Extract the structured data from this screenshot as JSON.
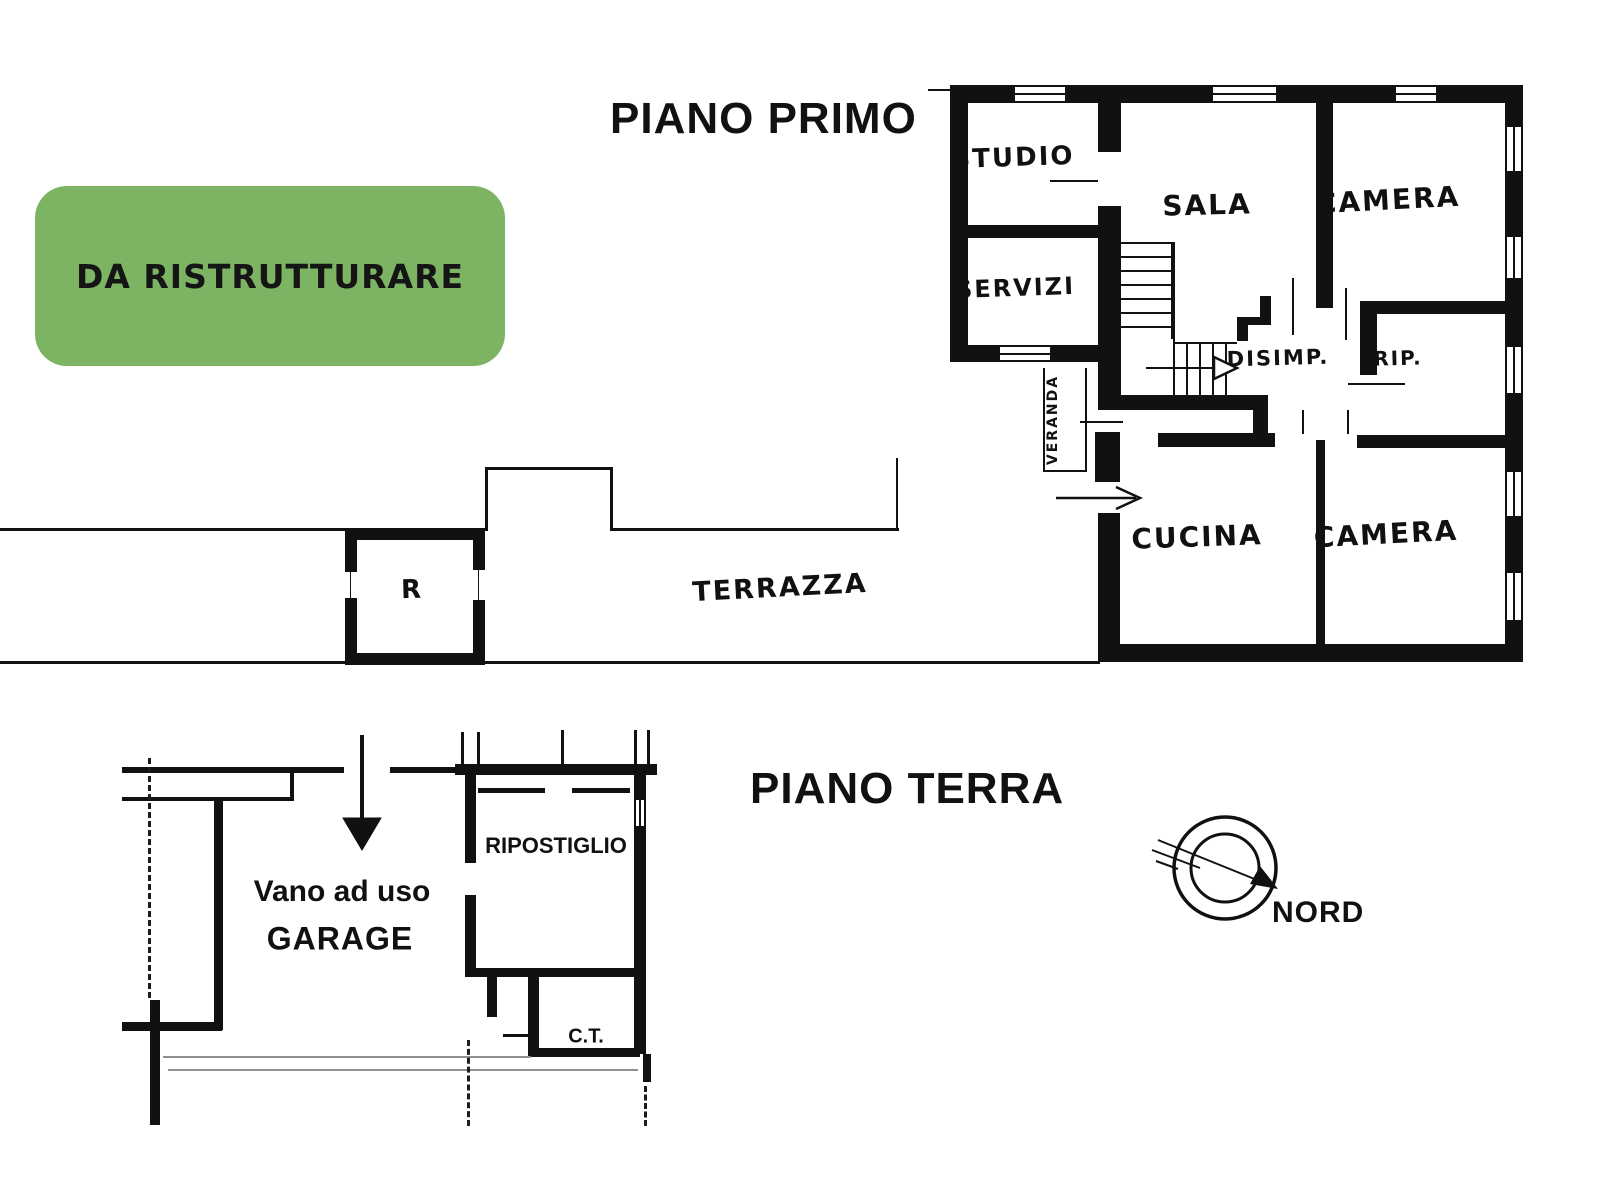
{
  "page": {
    "background": "#ffffff",
    "ink": "#111111"
  },
  "badge": {
    "text": "DA RISTRUTTURARE",
    "background": "#7db464"
  },
  "first_floor": {
    "title": "PIANO PRIMO",
    "rooms": {
      "studio": "STUDIO",
      "servizi": "SERVIZI",
      "sala": "SALA",
      "camera_top": "CAMERA",
      "disimpegno": "DISIMP.",
      "ripostiglio": "RIP.",
      "veranda": "VERANDA",
      "cucina": "CUCINA",
      "camera_bottom": "CAMERA"
    }
  },
  "terrace": {
    "label": "TERRAZZA",
    "small_room": "R"
  },
  "ground_floor": {
    "title": "PIANO TERRA",
    "rooms": {
      "garage_line1": "Vano ad uso",
      "garage_line2": "GARAGE",
      "ripostiglio": "RIPOSTIGLIO",
      "boiler_room": "C.T."
    }
  },
  "compass": {
    "label": "NORD"
  }
}
